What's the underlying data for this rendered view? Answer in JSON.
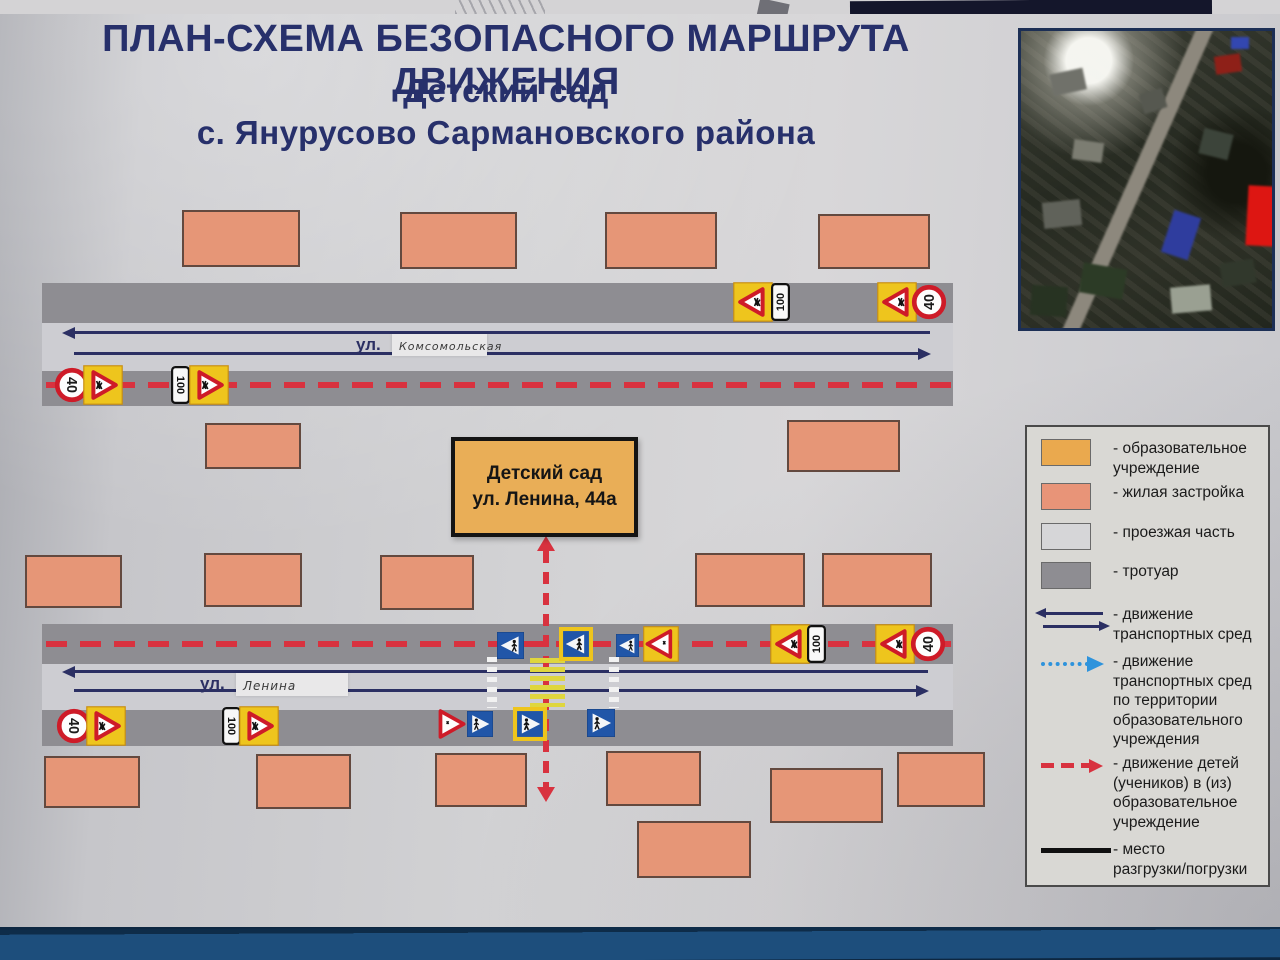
{
  "title": {
    "line1": "ПЛАН-СХЕМА БЕЗОПАСНОГО МАРШРУТА ДВИЖЕНИЯ",
    "line2": "Детский сад",
    "line3": "с. Янурусово Сармановского района"
  },
  "school": {
    "line1": "Детский сад",
    "line2": "ул. Ленина, 44а"
  },
  "roads": [
    {
      "prefix": "ул.",
      "name": "Комсомольская"
    },
    {
      "prefix": "ул.",
      "name": "Ленина"
    }
  ],
  "legend": {
    "items": [
      {
        "swatch": "orange",
        "lines": [
          "- образовательное",
          "учреждение"
        ]
      },
      {
        "swatch": "salmon",
        "lines": [
          "- жилая застройка"
        ]
      },
      {
        "swatch": "road",
        "lines": [
          "- проезжая часть"
        ]
      },
      {
        "swatch": "sidewalk",
        "lines": [
          "- тротуар"
        ]
      },
      {
        "swatch": "arrows-blue",
        "lines": [
          "- движение",
          "транспортных сред"
        ]
      },
      {
        "swatch": "arrow-dotted",
        "lines": [
          "- движение",
          "транспортных сред",
          "по территории",
          "образовательного",
          "учреждения"
        ]
      },
      {
        "swatch": "arrow-red-dashed",
        "lines": [
          "- движение детей",
          "(учеников) в (из)",
          "образовательное",
          "учреждение"
        ]
      },
      {
        "swatch": "line-black",
        "lines": [
          "- место",
          "разгрузки/погрузки"
        ]
      }
    ]
  },
  "colors": {
    "title_navy": "#27306b",
    "red_route": "#d8323f",
    "arrow_navy": "#2b2f63",
    "dotted_blue": "#2e93dc",
    "road": "#cdcdd2",
    "sidewalk": "#8e8d92",
    "residential": "#e69677",
    "school": "#e9ae57",
    "sign_yellow": "#eec51d",
    "sign_blue": "#2156a8",
    "sign_red": "#ce1b28",
    "zebra_yellow": "#dfd63e",
    "board_blue": "#1d4e7c"
  },
  "map": {
    "buildings": [
      {
        "x": 182,
        "y": 210,
        "w": 118,
        "h": 57
      },
      {
        "x": 400,
        "y": 212,
        "w": 117,
        "h": 57
      },
      {
        "x": 605,
        "y": 212,
        "w": 112,
        "h": 57
      },
      {
        "x": 818,
        "y": 214,
        "w": 112,
        "h": 55
      },
      {
        "x": 205,
        "y": 423,
        "w": 96,
        "h": 46
      },
      {
        "x": 787,
        "y": 420,
        "w": 113,
        "h": 52
      },
      {
        "x": 25,
        "y": 555,
        "w": 97,
        "h": 53
      },
      {
        "x": 204,
        "y": 553,
        "w": 98,
        "h": 54
      },
      {
        "x": 380,
        "y": 555,
        "w": 94,
        "h": 55
      },
      {
        "x": 695,
        "y": 553,
        "w": 110,
        "h": 54
      },
      {
        "x": 822,
        "y": 553,
        "w": 110,
        "h": 54
      },
      {
        "x": 44,
        "y": 756,
        "w": 96,
        "h": 52
      },
      {
        "x": 256,
        "y": 754,
        "w": 95,
        "h": 55
      },
      {
        "x": 435,
        "y": 753,
        "w": 92,
        "h": 54
      },
      {
        "x": 606,
        "y": 751,
        "w": 95,
        "h": 55
      },
      {
        "x": 770,
        "y": 768,
        "w": 113,
        "h": 55
      },
      {
        "x": 897,
        "y": 752,
        "w": 88,
        "h": 55
      },
      {
        "x": 637,
        "y": 821,
        "w": 114,
        "h": 57
      }
    ],
    "signs": [
      {
        "t": "speed40",
        "x": 72,
        "y": 385,
        "s": 36,
        "dir": "r"
      },
      {
        "t": "children",
        "x": 103,
        "y": 385,
        "s": 40,
        "dir": "r"
      },
      {
        "t": "dist100",
        "x": 180,
        "y": 385,
        "s": 38,
        "dir": "r"
      },
      {
        "t": "children",
        "x": 209,
        "y": 385,
        "s": 40,
        "dir": "r"
      },
      {
        "t": "children",
        "x": 753,
        "y": 302,
        "s": 40,
        "dir": "l"
      },
      {
        "t": "dist100",
        "x": 780,
        "y": 302,
        "s": 38,
        "dir": "l"
      },
      {
        "t": "children",
        "x": 897,
        "y": 302,
        "s": 40,
        "dir": "l"
      },
      {
        "t": "speed40",
        "x": 929,
        "y": 302,
        "s": 36,
        "dir": "l"
      },
      {
        "t": "pedblue",
        "x": 510,
        "y": 645,
        "s": 27,
        "dir": "l"
      },
      {
        "t": "pedyellow",
        "x": 576,
        "y": 644,
        "s": 34,
        "dir": "l"
      },
      {
        "t": "pedblue",
        "x": 627,
        "y": 645,
        "s": 23,
        "dir": "l"
      },
      {
        "t": "warnyellow",
        "x": 661,
        "y": 644,
        "s": 36,
        "dir": "l"
      },
      {
        "t": "children",
        "x": 790,
        "y": 644,
        "s": 40,
        "dir": "l"
      },
      {
        "t": "dist100",
        "x": 816,
        "y": 644,
        "s": 38,
        "dir": "l"
      },
      {
        "t": "children",
        "x": 895,
        "y": 644,
        "s": 40,
        "dir": "l"
      },
      {
        "t": "speed40",
        "x": 928,
        "y": 644,
        "s": 36,
        "dir": "l"
      },
      {
        "t": "speed40",
        "x": 74,
        "y": 726,
        "s": 36,
        "dir": "r"
      },
      {
        "t": "children",
        "x": 106,
        "y": 726,
        "s": 40,
        "dir": "r"
      },
      {
        "t": "dist100",
        "x": 231,
        "y": 726,
        "s": 38,
        "dir": "r"
      },
      {
        "t": "children",
        "x": 259,
        "y": 726,
        "s": 40,
        "dir": "r"
      },
      {
        "t": "warntri",
        "x": 450,
        "y": 724,
        "s": 34,
        "dir": "r"
      },
      {
        "t": "pedblue",
        "x": 480,
        "y": 724,
        "s": 26,
        "dir": "r"
      },
      {
        "t": "pedyellow",
        "x": 530,
        "y": 724,
        "s": 34,
        "dir": "r"
      },
      {
        "t": "pedblue",
        "x": 601,
        "y": 723,
        "s": 28,
        "dir": "r"
      }
    ]
  }
}
